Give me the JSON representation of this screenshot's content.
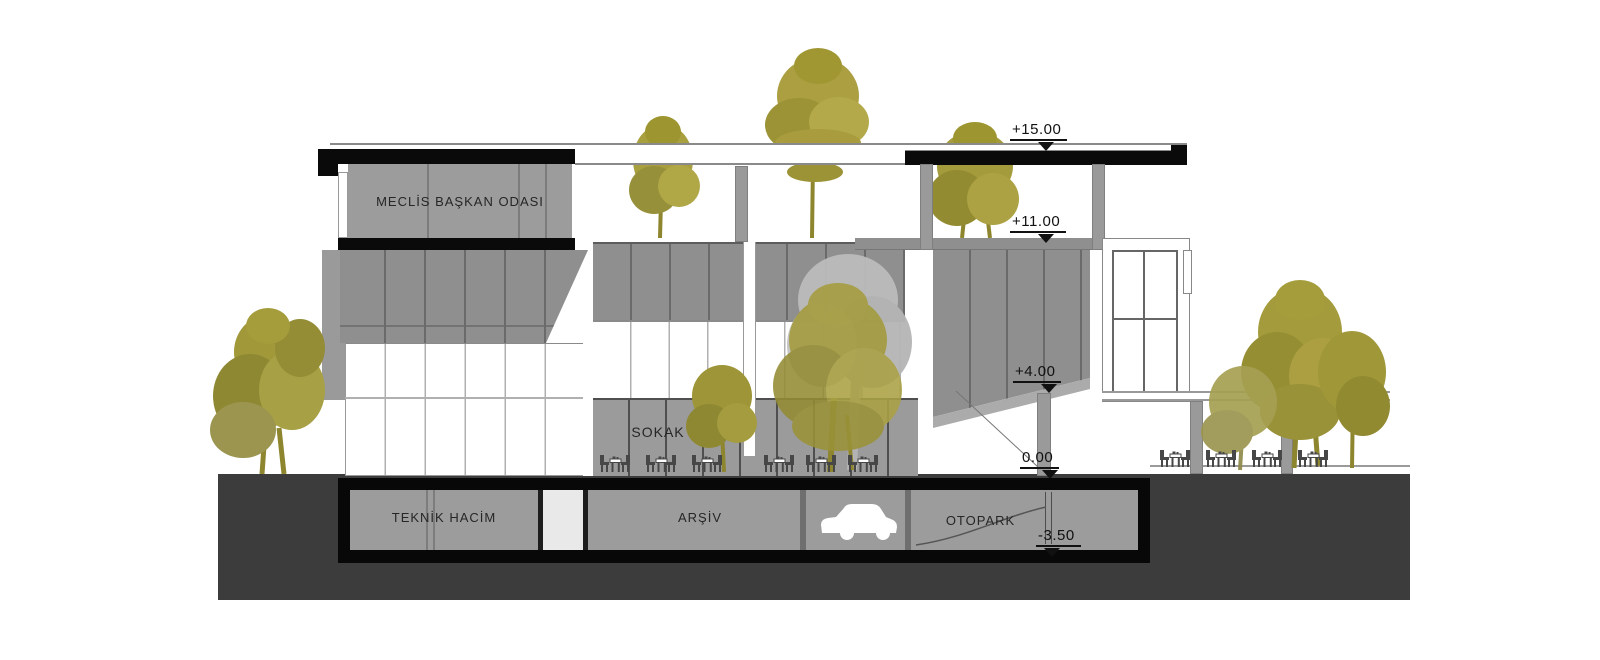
{
  "drawing": {
    "type": "architectural-section",
    "rooms": [
      {
        "id": "meclis-baskan-odasi",
        "label": "MECLİS BAŞKAN ODASI"
      },
      {
        "id": "sokak",
        "label": "SOKAK"
      },
      {
        "id": "teknik-hacim",
        "label": "TEKNİK HACİM"
      },
      {
        "id": "arsiv",
        "label": "ARŞİV"
      },
      {
        "id": "otopark",
        "label": "OTOPARK"
      }
    ],
    "elevation_markers": [
      {
        "id": "roof-level",
        "label": "+15.00"
      },
      {
        "id": "terrace-level",
        "label": "+11.00"
      },
      {
        "id": "first-floor-level",
        "label": "+4.00"
      },
      {
        "id": "ground-level",
        "label": "0.00"
      },
      {
        "id": "basement-level",
        "label": "-3.50"
      }
    ],
    "colors": {
      "facade_gray": "#8f8f8f",
      "room_gray": "#9c9c9c",
      "mullion_dark": "#5d5d5d",
      "slab_black": "#0a0a0a",
      "ground_dark": "#3c3c3c",
      "tree_olive": "#a59c3c",
      "tree_olive_dark": "#8e862f",
      "tree_olive_light": "#b2a94b",
      "tree_gray_backdrop": "#bcbcbc",
      "text": "#262626"
    }
  }
}
